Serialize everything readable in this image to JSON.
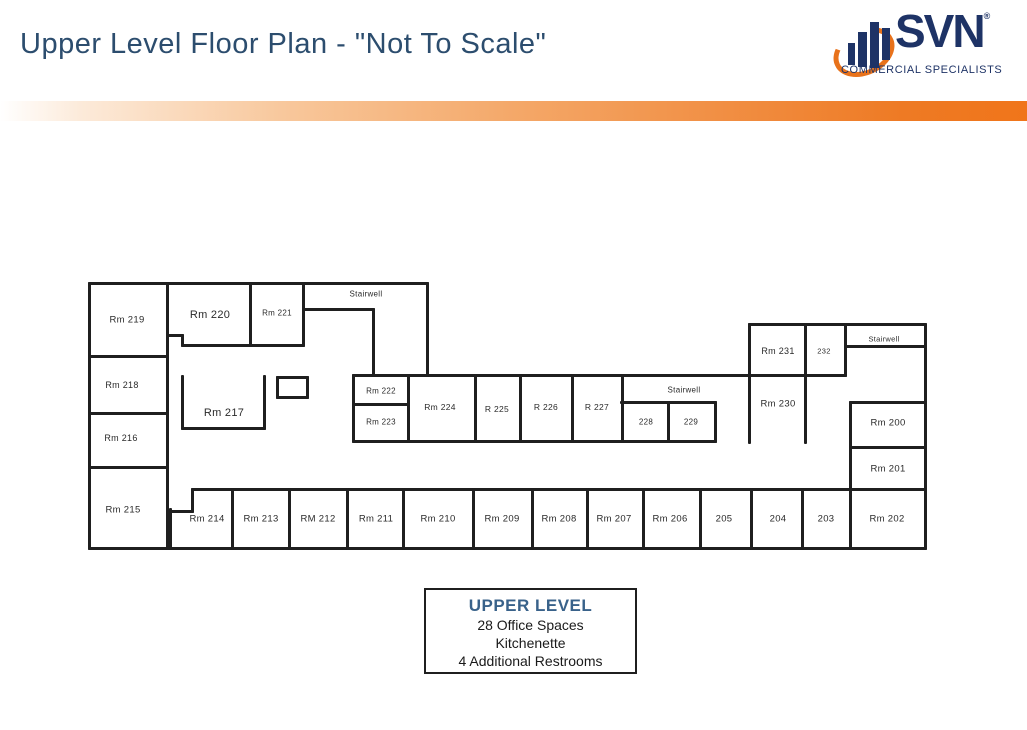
{
  "header": {
    "title": "Upper Level Floor Plan - \"Not To Scale\"",
    "title_color": "#2c4d6e"
  },
  "accent_bar": {
    "gradient_start": "#FFFFFF",
    "gradient_end": "#F0751A"
  },
  "logo": {
    "name": "SVN",
    "registered_mark": "®",
    "subtitle": "COMMERCIAL SPECIALISTS",
    "navy": "#1E3366",
    "orange": "#E8721B"
  },
  "legend": {
    "title": "UPPER LEVEL",
    "title_color": "#39628A",
    "lines": [
      "28 Office Spaces",
      "Kitchenette",
      "4 Additional Restrooms"
    ]
  },
  "floorplan": {
    "wall_color": "#1f1f1f",
    "walls_h": [
      [
        283,
        89,
        427
      ],
      [
        356,
        89,
        167
      ],
      [
        413,
        89,
        167
      ],
      [
        467,
        89,
        167
      ],
      [
        548,
        89,
        925
      ],
      [
        345,
        182,
        303
      ],
      [
        335,
        167,
        182
      ],
      [
        309,
        303,
        373
      ],
      [
        428,
        182,
        264
      ],
      [
        377,
        277,
        307
      ],
      [
        397,
        277,
        307
      ],
      [
        375,
        353,
        748
      ],
      [
        404,
        353,
        408
      ],
      [
        441,
        353,
        715
      ],
      [
        402,
        621,
        715
      ],
      [
        324,
        749,
        925
      ],
      [
        375,
        749,
        845
      ],
      [
        346,
        845,
        925
      ],
      [
        402,
        850,
        925
      ],
      [
        447,
        850,
        925
      ],
      [
        489,
        192,
        925
      ],
      [
        511,
        170,
        192
      ]
    ],
    "walls_v": [
      [
        89,
        283,
        548
      ],
      [
        167,
        283,
        548
      ],
      [
        182,
        335,
        345
      ],
      [
        250,
        283,
        345
      ],
      [
        303,
        283,
        345
      ],
      [
        373,
        309,
        375
      ],
      [
        427,
        283,
        375
      ],
      [
        182,
        376,
        428
      ],
      [
        264,
        376,
        428
      ],
      [
        277,
        377,
        397
      ],
      [
        307,
        377,
        397
      ],
      [
        353,
        375,
        441
      ],
      [
        408,
        375,
        441
      ],
      [
        475,
        375,
        441
      ],
      [
        520,
        375,
        441
      ],
      [
        572,
        375,
        441
      ],
      [
        622,
        375,
        441
      ],
      [
        668,
        402,
        441
      ],
      [
        715,
        402,
        441
      ],
      [
        749,
        324,
        442
      ],
      [
        805,
        324,
        442
      ],
      [
        845,
        324,
        375
      ],
      [
        925,
        324,
        548
      ],
      [
        850,
        402,
        548
      ],
      [
        170,
        509,
        548
      ],
      [
        192,
        489,
        511
      ],
      [
        232,
        489,
        548
      ],
      [
        289,
        489,
        548
      ],
      [
        347,
        489,
        548
      ],
      [
        403,
        489,
        548
      ],
      [
        473,
        489,
        548
      ],
      [
        532,
        489,
        548
      ],
      [
        587,
        489,
        548
      ],
      [
        643,
        489,
        548
      ],
      [
        700,
        489,
        548
      ],
      [
        751,
        489,
        548
      ],
      [
        802,
        489,
        548
      ]
    ],
    "labels": [
      {
        "t": "Rm 219",
        "x": 127,
        "y": 320,
        "s": 9.5
      },
      {
        "t": "Rm 218",
        "x": 122,
        "y": 385,
        "s": 9
      },
      {
        "t": "Rm 216",
        "x": 121,
        "y": 438,
        "s": 9
      },
      {
        "t": "Rm 215",
        "x": 123,
        "y": 510,
        "s": 9.5
      },
      {
        "t": "Rm 220",
        "x": 210,
        "y": 315,
        "s": 11
      },
      {
        "t": "Rm 221",
        "x": 277,
        "y": 313,
        "s": 8
      },
      {
        "t": "Stairwell",
        "x": 366,
        "y": 294,
        "s": 8
      },
      {
        "t": "Rm 217",
        "x": 224,
        "y": 413,
        "s": 11
      },
      {
        "t": "Rm 222",
        "x": 381,
        "y": 391,
        "s": 8
      },
      {
        "t": "Rm 223",
        "x": 381,
        "y": 422,
        "s": 8
      },
      {
        "t": "Rm 224",
        "x": 440,
        "y": 407,
        "s": 8.5
      },
      {
        "t": "R 225",
        "x": 497,
        "y": 409,
        "s": 8.5
      },
      {
        "t": "R 226",
        "x": 546,
        "y": 407,
        "s": 8.5
      },
      {
        "t": "R 227",
        "x": 597,
        "y": 407,
        "s": 8.5
      },
      {
        "t": "Stairwell",
        "x": 684,
        "y": 390,
        "s": 8
      },
      {
        "t": "228",
        "x": 646,
        "y": 422,
        "s": 8
      },
      {
        "t": "229",
        "x": 691,
        "y": 422,
        "s": 8
      },
      {
        "t": "Rm 231",
        "x": 778,
        "y": 351,
        "s": 9
      },
      {
        "t": "232",
        "x": 824,
        "y": 351,
        "s": 7.5
      },
      {
        "t": "Stairwell",
        "x": 884,
        "y": 339,
        "s": 7.5
      },
      {
        "t": "Rm 230",
        "x": 778,
        "y": 404,
        "s": 9.5
      },
      {
        "t": "Rm 200",
        "x": 888,
        "y": 423,
        "s": 9.5
      },
      {
        "t": "Rm 201",
        "x": 888,
        "y": 469,
        "s": 9.5
      },
      {
        "t": "Rm 214",
        "x": 207,
        "y": 519,
        "s": 9.5
      },
      {
        "t": "Rm 213",
        "x": 261,
        "y": 519,
        "s": 9.5
      },
      {
        "t": "RM 212",
        "x": 318,
        "y": 519,
        "s": 9.5
      },
      {
        "t": "Rm 211",
        "x": 376,
        "y": 519,
        "s": 9.5
      },
      {
        "t": "Rm 210",
        "x": 438,
        "y": 519,
        "s": 9.5
      },
      {
        "t": "Rm 209",
        "x": 502,
        "y": 519,
        "s": 9.5
      },
      {
        "t": "Rm 208",
        "x": 559,
        "y": 519,
        "s": 9.5
      },
      {
        "t": "Rm 207",
        "x": 614,
        "y": 519,
        "s": 9.5
      },
      {
        "t": "Rm 206",
        "x": 670,
        "y": 519,
        "s": 9.5
      },
      {
        "t": "205",
        "x": 724,
        "y": 519,
        "s": 9.5
      },
      {
        "t": "204",
        "x": 778,
        "y": 519,
        "s": 9.5
      },
      {
        "t": "203",
        "x": 826,
        "y": 519,
        "s": 9.5
      },
      {
        "t": "Rm 202",
        "x": 887,
        "y": 519,
        "s": 9.5
      }
    ]
  }
}
